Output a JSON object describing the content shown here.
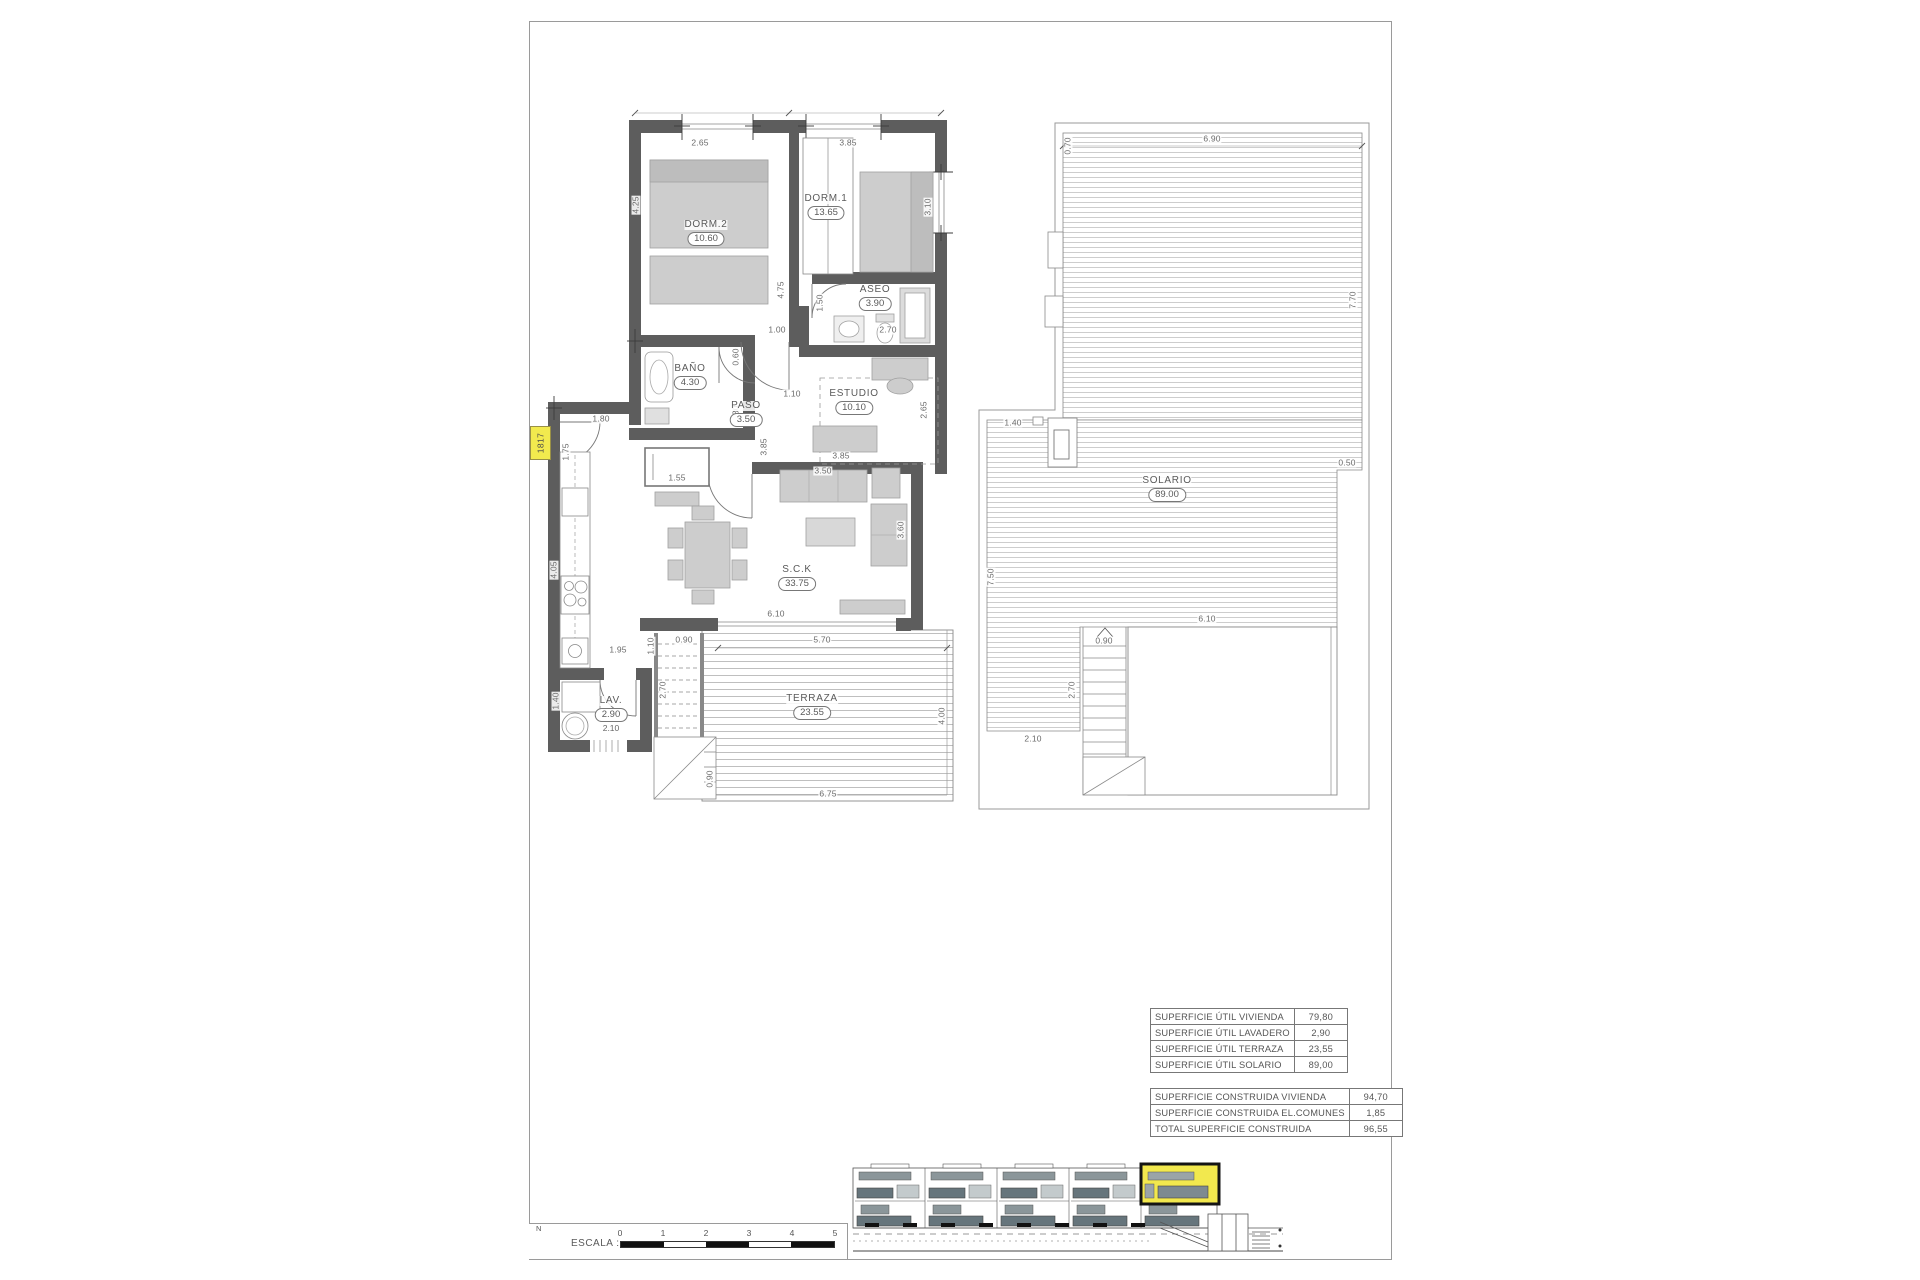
{
  "colors": {
    "accent_yellow": "#f2ea4e",
    "wall_gray": "#5d5d5d",
    "hatch_gray": "#c4c4c4",
    "text_gray": "#5a5a5a"
  },
  "unit_tag": "1817",
  "plan": {
    "rooms": {
      "dorm2": {
        "name": "DORM.2",
        "area": "10.60"
      },
      "dorm1": {
        "name": "DORM.1",
        "area": "13.65"
      },
      "aseo": {
        "name": "ASEO",
        "area": "3.90"
      },
      "bano": {
        "name": "BAÑO",
        "area": "4.30"
      },
      "paso": {
        "name": "PASO",
        "area": "3.50"
      },
      "estudio": {
        "name": "ESTUDIO",
        "area": "10.10"
      },
      "sck": {
        "name": "S.C.K",
        "area": "33.75"
      },
      "lav": {
        "name": "LAV.",
        "area": "2.90",
        "extra": "2.10"
      },
      "terraza": {
        "name": "TERRAZA",
        "area": "23.55"
      },
      "solario": {
        "name": "SOLARIO",
        "area": "89.00"
      }
    },
    "dims": {
      "dorm2_w": "2.65",
      "dorm1_w": "3.85",
      "dorm2_h": "4.25",
      "dorm1_h": "4.75",
      "dorm1_r": "3.10",
      "aseo_h": "1.50",
      "aseo_w": "2.70",
      "hall_a": "1.00",
      "hall_b": "1.10",
      "bano_a": "0.60",
      "bano_b": "2.80",
      "hall_c": "3.85",
      "estudio_r": "2.65",
      "estudio_w": "3.85",
      "sofa_w": "3.50",
      "sofa_h": "3.60",
      "entry_w": "1.80",
      "entry_h": "1.75",
      "closet_w": "1.55",
      "kitchen_h": "4.05",
      "kitchen_w": "1.95",
      "stair_a": "1.10",
      "stair_b": "0.90",
      "stair_c": "2.70",
      "terraza_top": "5.70",
      "sck_w": "6.10",
      "terraza_r": "4.00",
      "terraza_b": "6.75",
      "stair_d": "0.90",
      "lav_h": "1.40"
    },
    "solario_dims": {
      "top_l": "0.70",
      "top": "6.90",
      "right": "7.70",
      "right_b": "0.50",
      "mid": "1.40",
      "left": "7.50",
      "col_b": "2.10",
      "lower_w": "6.10",
      "stair_w": "0.90",
      "stair_h": "2.70"
    }
  },
  "table": {
    "util": {
      "rows": [
        {
          "label": "SUPERFICIE ÚTIL VIVIENDA",
          "value": "79,80"
        },
        {
          "label": "SUPERFICIE ÚTIL LAVADERO",
          "value": "2,90"
        },
        {
          "label": "SUPERFICIE ÚTIL TERRAZA",
          "value": "23,55"
        },
        {
          "label": "SUPERFICIE ÚTIL SOLARIO",
          "value": "89,00"
        }
      ]
    },
    "construida": {
      "rows": [
        {
          "label": "SUPERFICIE CONSTRUIDA VIVIENDA",
          "value": "94,70"
        },
        {
          "label": "SUPERFICIE CONSTRUIDA EL.COMUNES",
          "value": "1,85"
        },
        {
          "label": "TOTAL SUPERFICIE CONSTRUIDA",
          "value": "96,55"
        }
      ]
    }
  },
  "scalebar": {
    "label": "ESCALA :",
    "north": "N",
    "ticks": [
      "0",
      "1",
      "2",
      "3",
      "4",
      "5"
    ]
  }
}
